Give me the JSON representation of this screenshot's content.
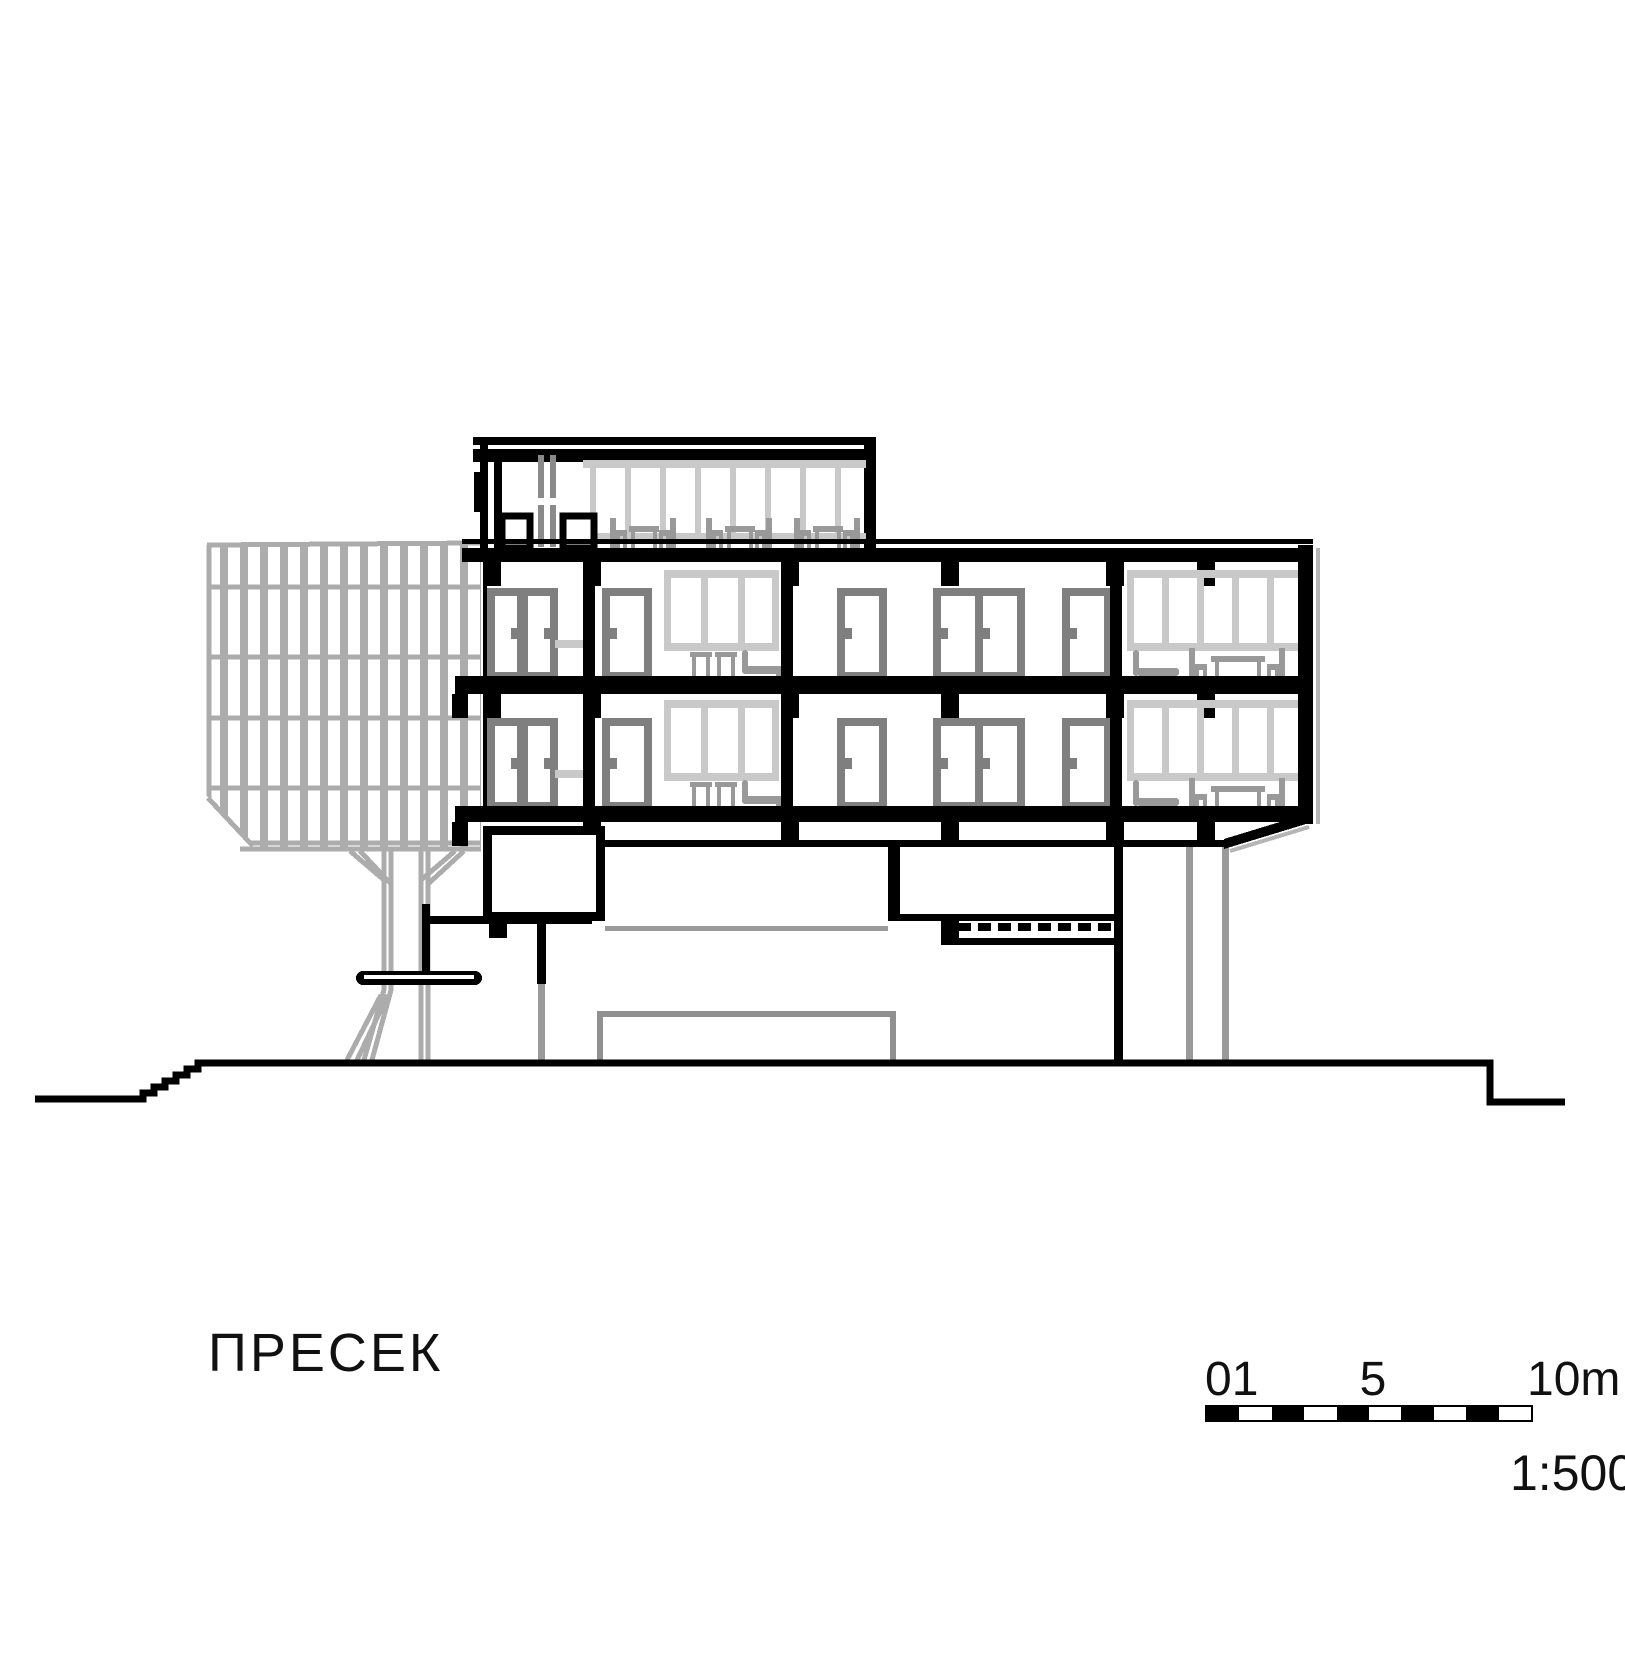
{
  "drawing": {
    "title": "ПРЕСЕК",
    "type": "architectural-building-section",
    "floors_visible": 3,
    "context_elements": [
      "slatted-tree-canopy",
      "tree-trunk",
      "sunken-pit",
      "ground-stairs"
    ]
  },
  "scale_bar": {
    "labels": {
      "zero": "01",
      "mid": "5",
      "end": "10m"
    },
    "ratio": "1:500",
    "segments": 10
  },
  "colors": {
    "section_cut": "#000000",
    "doors": "#7f7f7f",
    "furniture": "#999999",
    "glazing": "#c9c9c9",
    "context_gray": "#acacac",
    "shadow_gray": "#b5b5b5",
    "background": "#ffffff"
  }
}
